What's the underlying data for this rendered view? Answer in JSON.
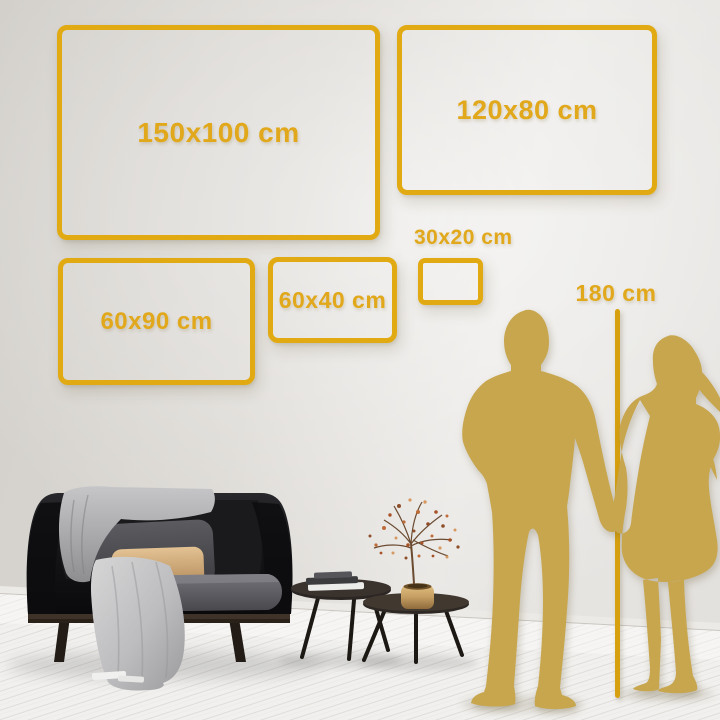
{
  "size_comparison": {
    "frames": [
      {
        "label": "150x100 cm",
        "width_cm": 150,
        "height_cm": 100
      },
      {
        "label": "120x80 cm",
        "width_cm": 120,
        "height_cm": 80
      },
      {
        "label": "60x90 cm",
        "width_cm": 60,
        "height_cm": 90
      },
      {
        "label": "60x40 cm",
        "width_cm": 60,
        "height_cm": 40
      },
      {
        "label": "30x20 cm",
        "width_cm": 30,
        "height_cm": 20
      }
    ],
    "person_height_reference": {
      "label": "180 cm",
      "value_cm": 180
    }
  },
  "colors": {
    "frame_gold": "#E1A912",
    "label_gold": "#E2A81B",
    "silhouette_gold": "#C8A64E",
    "marker_line_gold": "#D7A00E",
    "wall_dark": "#D2CFCA",
    "wall_light": "#EAE8E5",
    "floor": "#F1F0EE"
  }
}
